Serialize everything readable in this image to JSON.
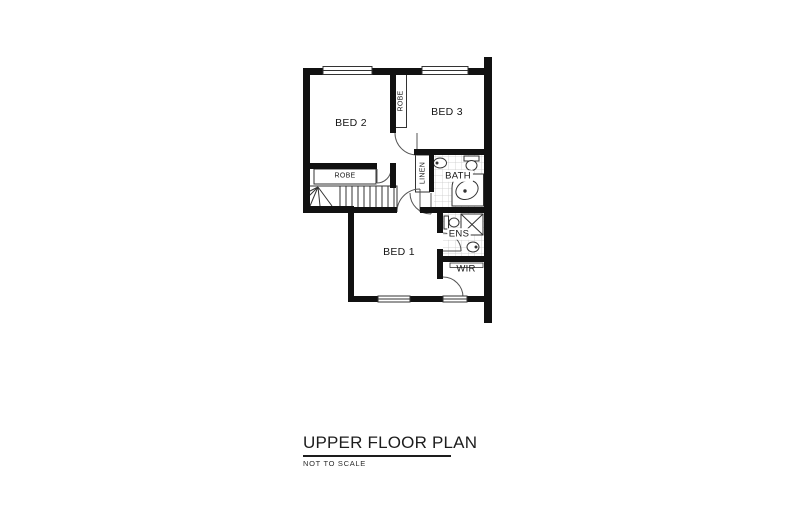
{
  "title": {
    "text": "UPPER FLOOR PLAN",
    "subtitle": "NOT TO SCALE"
  },
  "colors": {
    "wall": "#111111",
    "line": "#333333",
    "tile": "#c9c9c9",
    "text": "#161616",
    "paper": "#ffffff"
  },
  "rooms": [
    {
      "id": "bed-2",
      "label": "BED 2",
      "x": 351,
      "y": 123,
      "rotate": 0,
      "size": 10.5
    },
    {
      "id": "bed-3",
      "label": "BED 3",
      "x": 447,
      "y": 112,
      "rotate": 0,
      "size": 10.5
    },
    {
      "id": "bed-1",
      "label": "BED 1",
      "x": 399,
      "y": 252,
      "rotate": 0,
      "size": 10.5
    },
    {
      "id": "bath",
      "label": "BATH",
      "x": 458,
      "y": 176,
      "rotate": 0,
      "size": 9.5,
      "bg": true
    },
    {
      "id": "ens",
      "label": "ENS",
      "x": 459,
      "y": 234,
      "rotate": 0,
      "size": 9.5,
      "bg": true
    },
    {
      "id": "wir",
      "label": "WIR",
      "x": 466,
      "y": 269,
      "rotate": 0,
      "size": 9.5
    },
    {
      "id": "robe-lower",
      "label": "ROBE",
      "x": 345,
      "y": 176,
      "rotate": 0,
      "size": 7
    },
    {
      "id": "robe-upper",
      "label": "ROBE",
      "x": 401,
      "y": 101,
      "rotate": -90,
      "size": 7
    },
    {
      "id": "linen",
      "label": "LINEN",
      "x": 423,
      "y": 173,
      "rotate": -90,
      "size": 7
    }
  ]
}
